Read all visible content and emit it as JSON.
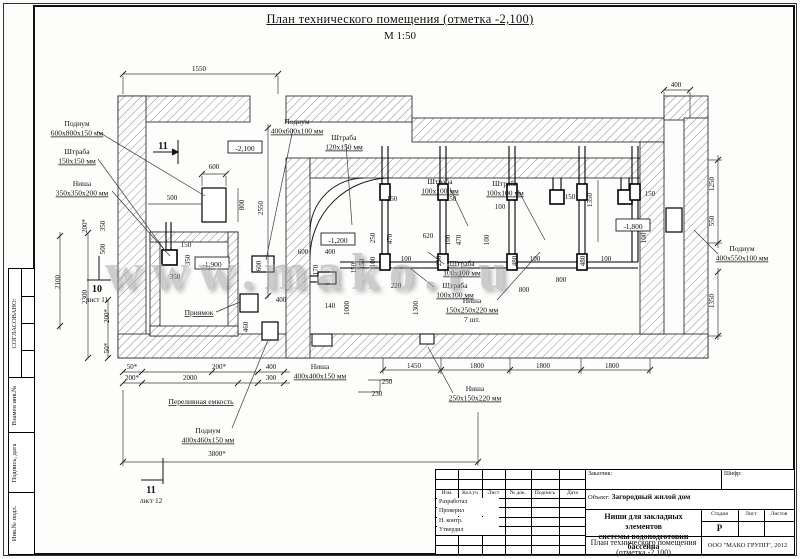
{
  "page": {
    "title": "План технического помещения (отметка -2,100)",
    "scale": "М 1:50",
    "watermark": "www.mako.ru"
  },
  "sidebar": {
    "agreed_label": "СОГЛАСОВАНО:",
    "strips": [
      "Взамен инв.№",
      "Подпись, дата",
      "Инв.№ подл."
    ]
  },
  "title_block": {
    "customer_label": "Заказчик:",
    "code_label": "Шифр:",
    "object_label": "Объект:",
    "object_value": "Загородный жилой дом",
    "doc_title_line1": "Ниши для закладных элементов",
    "doc_title_line2": "системы водоподготовки бассейна",
    "sheet_title_line1": "План технического помещения",
    "sheet_title_line2": "(отметка -2,100)",
    "stage_label": "Стадия",
    "sheet_label": "Лист",
    "sheets_label": "Листов",
    "stage_value": "Р",
    "company": "ООО \"МАКО ГРУПП\", 2012",
    "rev_headers": [
      "Изм.",
      "Кол.уч",
      "Лист",
      "№ док.",
      "Подпись",
      "Дата"
    ],
    "roles": [
      "Разработал",
      "Проверил",
      "Н. контр.",
      "Утвердил"
    ]
  },
  "drawing": {
    "elevations": [
      {
        "t": "-2,100",
        "x": 245,
        "y": 149
      },
      {
        "t": "-1,900",
        "x": 212,
        "y": 265
      },
      {
        "t": "-1,200",
        "x": 338,
        "y": 241
      },
      {
        "t": "-1,800",
        "x": 633,
        "y": 227
      }
    ],
    "annotations": [
      {
        "lines": [
          "Подиум",
          "600х800х150 мм"
        ],
        "x": 77,
        "y": 126
      },
      {
        "lines": [
          "Штраба",
          "150х150 мм"
        ],
        "x": 77,
        "y": 154
      },
      {
        "lines": [
          "Ниша",
          "350х350х200 мм"
        ],
        "x": 82,
        "y": 186
      },
      {
        "lines": [
          "Подиум",
          "400х600х100 мм"
        ],
        "x": 297,
        "y": 124
      },
      {
        "lines": [
          "Штраба",
          "120х150 мм"
        ],
        "x": 344,
        "y": 140
      },
      {
        "lines": [
          "Штраба",
          "100х100 мм"
        ],
        "x": 440,
        "y": 184
      },
      {
        "lines": [
          "Штраба",
          "100х100 мм"
        ],
        "x": 505,
        "y": 186
      },
      {
        "lines": [
          "Штраба",
          "100х100 мм"
        ],
        "x": 462,
        "y": 266
      },
      {
        "lines": [
          "Штраба",
          "100х100 мм"
        ],
        "x": 455,
        "y": 288
      },
      {
        "lines": [
          "Ниша",
          "150х250х220 мм",
          "7 шт."
        ],
        "x": 472,
        "y": 303
      },
      {
        "lines": [
          "Подиум",
          "400х550х100 мм"
        ],
        "x": 742,
        "y": 251
      },
      {
        "lines": [
          "Приямок"
        ],
        "x": 199,
        "y": 315,
        "u": true
      },
      {
        "lines": [
          "Переливная емкость"
        ],
        "x": 201,
        "y": 404,
        "u": true
      },
      {
        "lines": [
          "Подиум",
          "400х460х150 мм"
        ],
        "x": 208,
        "y": 433
      },
      {
        "lines": [
          "Ниша",
          "400х400х150 мм"
        ],
        "x": 320,
        "y": 369
      },
      {
        "lines": [
          "Ниша",
          "250х150х220 мм"
        ],
        "x": 475,
        "y": 391
      }
    ],
    "dims": [
      {
        "t": "1550",
        "x": 199,
        "y": 71
      },
      {
        "t": "400",
        "x": 676,
        "y": 87
      },
      {
        "t": "600",
        "x": 214,
        "y": 169
      },
      {
        "t": "800",
        "x": 244,
        "y": 205,
        "r": -90
      },
      {
        "t": "2550",
        "x": 263,
        "y": 208,
        "r": -90
      },
      {
        "t": "600",
        "x": 261,
        "y": 266,
        "r": -90
      },
      {
        "t": "500",
        "x": 172,
        "y": 200
      },
      {
        "t": "150",
        "x": 186,
        "y": 247
      },
      {
        "t": "350",
        "x": 175,
        "y": 279
      },
      {
        "t": "350",
        "x": 190,
        "y": 260,
        "r": -90
      },
      {
        "t": "200*",
        "x": 87,
        "y": 226,
        "r": -90
      },
      {
        "t": "350",
        "x": 105,
        "y": 226,
        "r": -90
      },
      {
        "t": "500",
        "x": 105,
        "y": 249,
        "r": -90
      },
      {
        "t": "2300",
        "x": 87,
        "y": 297,
        "r": -90
      },
      {
        "t": "2100",
        "x": 60,
        "y": 282,
        "r": -90
      },
      {
        "t": "200*",
        "x": 109,
        "y": 316,
        "r": -90
      },
      {
        "t": "50*",
        "x": 109,
        "y": 348,
        "r": -90
      },
      {
        "t": "600",
        "x": 303,
        "y": 254
      },
      {
        "t": "400",
        "x": 330,
        "y": 254
      },
      {
        "t": "170",
        "x": 318,
        "y": 270,
        "r": -90
      },
      {
        "t": "150",
        "x": 356,
        "y": 268,
        "r": -90
      },
      {
        "t": "140",
        "x": 330,
        "y": 308
      },
      {
        "t": "1000",
        "x": 349,
        "y": 308,
        "r": -90
      },
      {
        "t": "1300",
        "x": 418,
        "y": 308,
        "r": -90
      },
      {
        "t": "220",
        "x": 396,
        "y": 288
      },
      {
        "t": "150",
        "x": 392,
        "y": 201
      },
      {
        "t": "150",
        "x": 451,
        "y": 201
      },
      {
        "t": "100",
        "x": 500,
        "y": 209
      },
      {
        "t": "150",
        "x": 570,
        "y": 199
      },
      {
        "t": "150",
        "x": 650,
        "y": 196
      },
      {
        "t": "1350",
        "x": 592,
        "y": 200,
        "r": -90
      },
      {
        "t": "250",
        "x": 375,
        "y": 238,
        "r": -90
      },
      {
        "t": "470",
        "x": 392,
        "y": 239,
        "r": -90
      },
      {
        "t": "620",
        "x": 428,
        "y": 238
      },
      {
        "t": "100",
        "x": 450,
        "y": 240,
        "r": -90
      },
      {
        "t": "470",
        "x": 461,
        "y": 240,
        "r": -90
      },
      {
        "t": "100",
        "x": 489,
        "y": 240,
        "r": -90
      },
      {
        "t": "100",
        "x": 646,
        "y": 238,
        "r": -90
      },
      {
        "t": "100",
        "x": 406,
        "y": 261
      },
      {
        "t": "100",
        "x": 375,
        "y": 262,
        "r": -90
      },
      {
        "t": "150",
        "x": 364,
        "y": 264,
        "r": -90
      },
      {
        "t": "250",
        "x": 441,
        "y": 261,
        "r": -90
      },
      {
        "t": "480",
        "x": 517,
        "y": 261,
        "r": -90
      },
      {
        "t": "100",
        "x": 535,
        "y": 261
      },
      {
        "t": "480",
        "x": 585,
        "y": 261,
        "r": -90
      },
      {
        "t": "100",
        "x": 606,
        "y": 261
      },
      {
        "t": "800",
        "x": 561,
        "y": 282
      },
      {
        "t": "800",
        "x": 524,
        "y": 292
      },
      {
        "t": "1250",
        "x": 714,
        "y": 184,
        "r": -90
      },
      {
        "t": "550",
        "x": 714,
        "y": 221,
        "r": -90
      },
      {
        "t": "1350",
        "x": 714,
        "y": 301,
        "r": -90
      },
      {
        "t": "1450",
        "x": 414,
        "y": 368
      },
      {
        "t": "1800",
        "x": 477,
        "y": 368
      },
      {
        "t": "1800",
        "x": 543,
        "y": 368
      },
      {
        "t": "1800",
        "x": 612,
        "y": 368
      },
      {
        "t": "50*",
        "x": 132,
        "y": 369
      },
      {
        "t": "200*",
        "x": 132,
        "y": 380
      },
      {
        "t": "200*",
        "x": 219,
        "y": 369
      },
      {
        "t": "2000",
        "x": 190,
        "y": 380
      },
      {
        "t": "400",
        "x": 271,
        "y": 369
      },
      {
        "t": "300",
        "x": 271,
        "y": 380
      },
      {
        "t": "460",
        "x": 248,
        "y": 327,
        "r": -90
      },
      {
        "t": "400",
        "x": 281,
        "y": 302
      },
      {
        "t": "250",
        "x": 387,
        "y": 384
      },
      {
        "t": "230",
        "x": 377,
        "y": 396
      },
      {
        "t": "3800*",
        "x": 217,
        "y": 456
      }
    ],
    "sections": [
      {
        "num": "11",
        "sheet": "",
        "x": 163,
        "y": 149
      },
      {
        "num": "10",
        "sheet": "лист 11",
        "x": 97,
        "y": 292
      },
      {
        "num": "11",
        "sheet": "лист 12",
        "x": 151,
        "y": 493
      }
    ]
  }
}
